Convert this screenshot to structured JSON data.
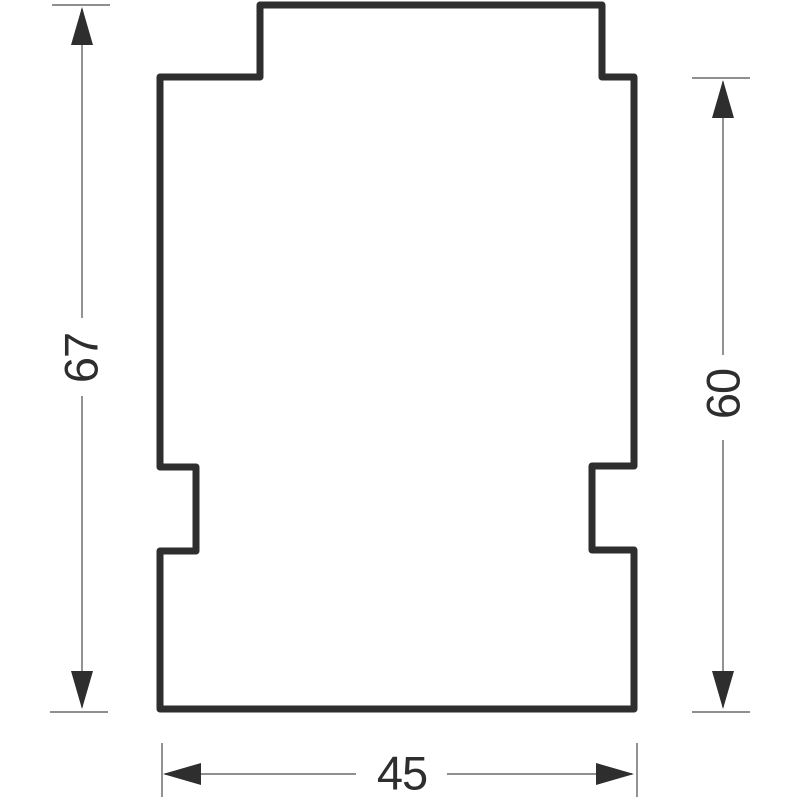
{
  "drawing": {
    "kind": "technical-dimension-drawing",
    "dimensions": {
      "overall_height": {
        "label": "67",
        "orientation": "vertical",
        "side": "left"
      },
      "body_height": {
        "label": "60",
        "orientation": "vertical",
        "side": "right"
      },
      "overall_width": {
        "label": "45",
        "orientation": "horizontal",
        "side": "bottom"
      }
    },
    "colors": {
      "background": "#ffffff",
      "outline": "#2e2e2e",
      "dimension_lines": "#7f7f7f",
      "arrowheads": "#2e2e2e",
      "text": "#2e2e2e"
    }
  }
}
